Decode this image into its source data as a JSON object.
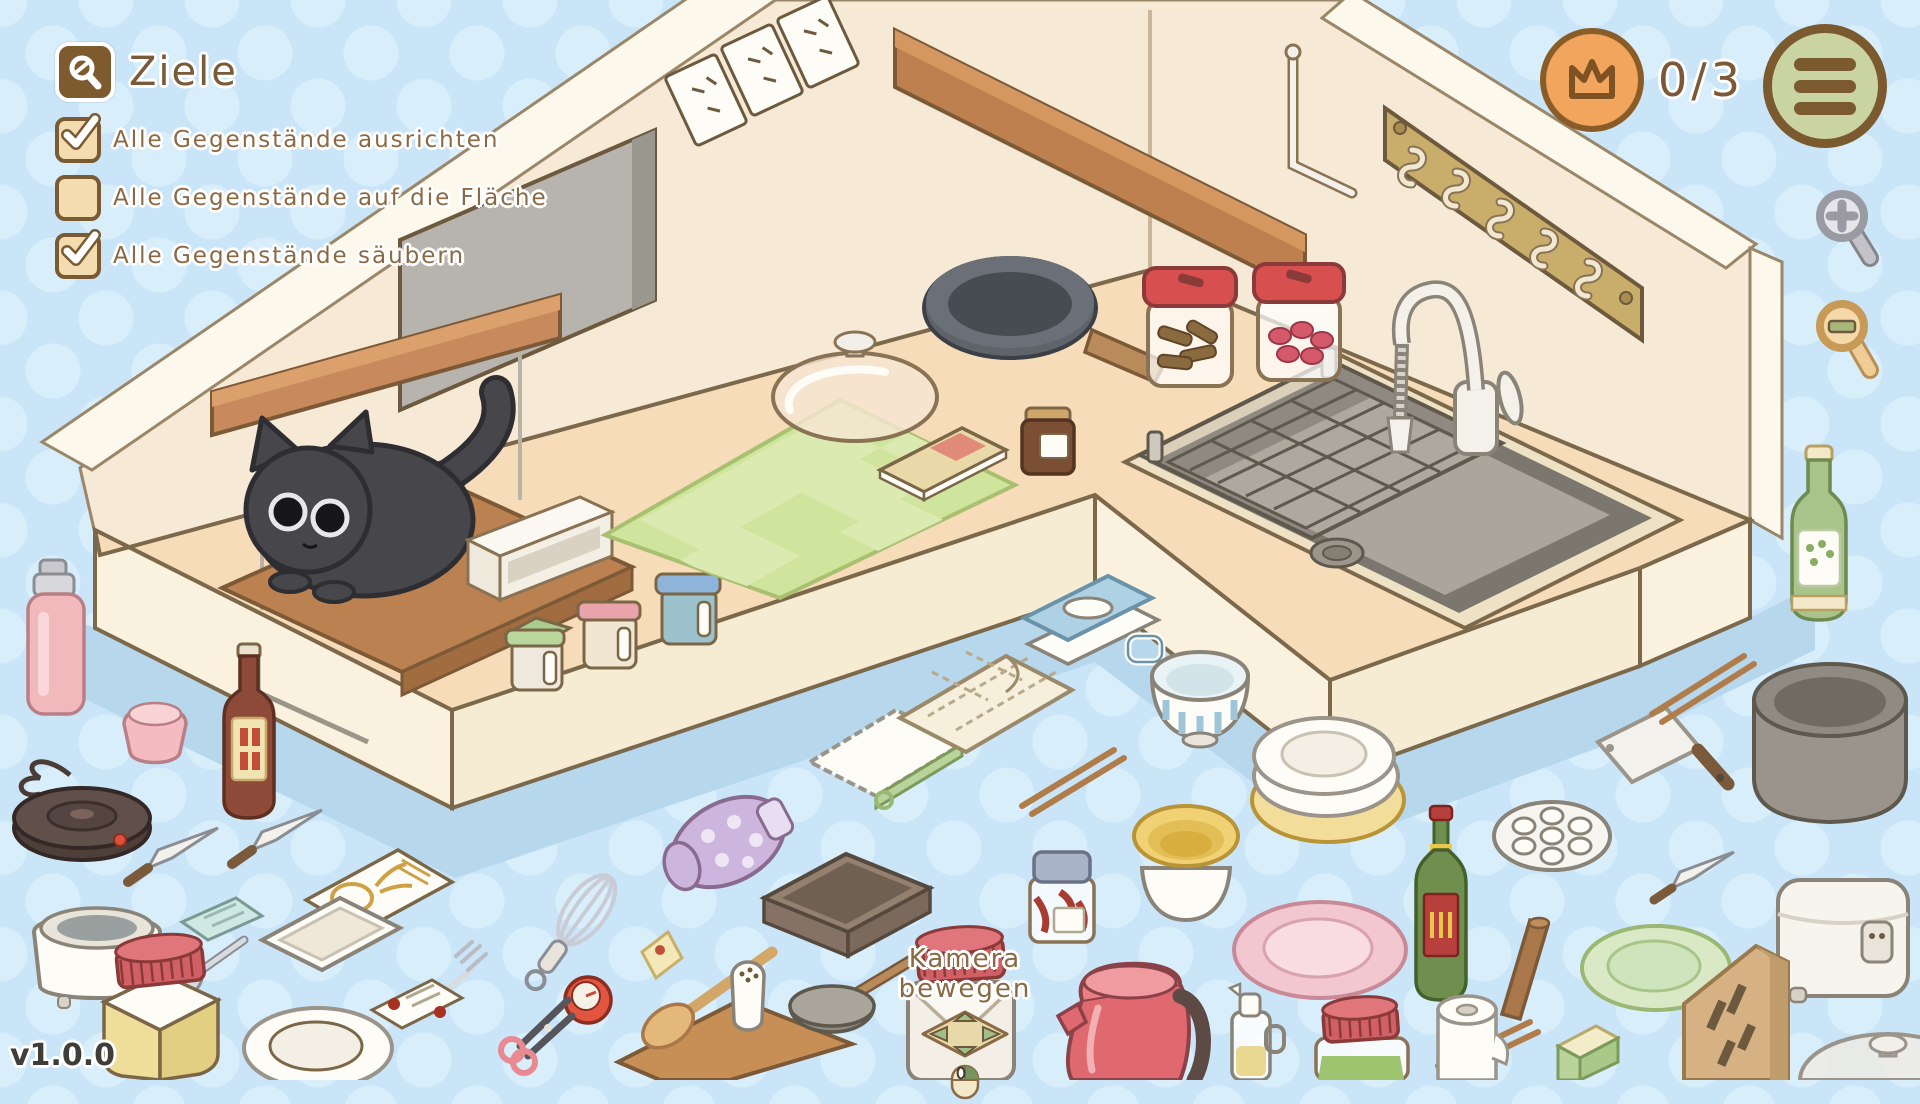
{
  "goals_panel": {
    "icon": "goals-magnifier-icon",
    "title": "Ziele",
    "goals": [
      {
        "label": "Alle Gegenstände ausrichten",
        "checked": true
      },
      {
        "label": "Alle Gegenstände auf die Fläche",
        "checked": false
      },
      {
        "label": "Alle Gegenstände säubern",
        "checked": true
      }
    ]
  },
  "status_bar": {
    "crown_icon": "crown-icon",
    "progress": "0/3",
    "menu_icon": "hamburger-menu-icon"
  },
  "zoom_controls": {
    "zoom_in_icon": "magnifier-plus-icon",
    "zoom_out_icon": "magnifier-minus-icon"
  },
  "camera_hint": {
    "label": "Kamera bewegen",
    "pad_icon": "arrow-pad-icon",
    "mouse_icon": "mouse-drag-icon"
  },
  "version": "v1.0.0",
  "colors": {
    "background": "#c9e5f7",
    "dots": "#d9eefb",
    "wall": "#f6ead6",
    "wall_trim": "#fdf8ec",
    "counter_top": "#f6dcb8",
    "counter_face": "#faf1de",
    "shadow": "#b7d7ec",
    "outline": "#7b6747",
    "text_brown": "#8a6a45",
    "badge_orange": "#f2a55c",
    "menu_green": "#c9d4a2",
    "icon_brown": "#7d5b2f",
    "kettle_red": "#e0696f",
    "jar_lid_red": "#d84f50",
    "mat_green": "#cfe49c",
    "cat_gray": "#47464b",
    "wood": "#c8895c"
  },
  "scene": {
    "items": [
      "black-cat",
      "cat-wood-board",
      "hanging-shelf-plank",
      "chalkboard",
      "power-outlets",
      "wall-plank-shelf",
      "metal-swing-rod",
      "hook-rail",
      "green-checker-mat",
      "recipe-book",
      "white-organizer-bench",
      "canister-green",
      "canister-pink",
      "canister-blue",
      "glass-pot-lid",
      "frying-pan",
      "brown-spice-jar",
      "jar-cinnamon",
      "jar-candy",
      "sink-basin",
      "wire-basket",
      "faucet",
      "thermos-pink",
      "pink-cup",
      "sauce-bottle",
      "hot-plate",
      "paring-knife-left",
      "paring-knife-left2",
      "teal-card",
      "seed-packet",
      "slow-cooker",
      "silver-spoon",
      "white-dish",
      "silver-fork",
      "whisk",
      "kitchen-timer",
      "mustard-jar",
      "white-plate",
      "recipe-card",
      "scissors",
      "cutting-board",
      "wooden-spatula",
      "yellow-note",
      "salt-shaker",
      "ladle",
      "brown-baking-pan",
      "oven-mitt",
      "white-towel",
      "check-towel",
      "butter-dish",
      "striped-bowl",
      "chopsticks-1",
      "jam-jar",
      "yellow-bowl-stack",
      "red-kettle",
      "oil-dispenser",
      "kamera-jar",
      "plates-stack",
      "pink-plate",
      "wine-bottle",
      "steamer-plate",
      "cleaver",
      "chopsticks-2",
      "big-pot",
      "paring-knife-right",
      "wooden-roller",
      "green-plate",
      "rice-cooker",
      "green-jar",
      "chopsticks-3",
      "sponge",
      "paper-roll",
      "knife-block",
      "green-bottle",
      "glass-lid-corner"
    ]
  }
}
